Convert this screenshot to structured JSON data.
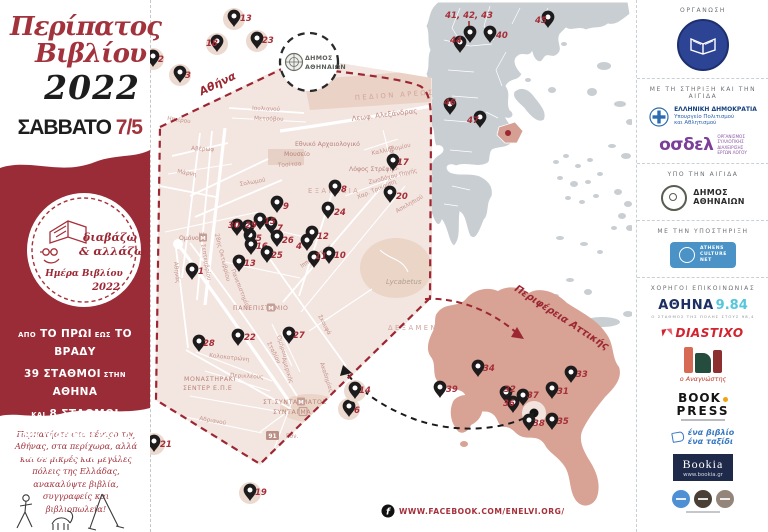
{
  "left": {
    "title1": "Περίπατος",
    "title2": "Βιβλίου",
    "year": "2022",
    "day": "ΣΑΒΒΑΤΟ",
    "date": "7/5",
    "badge": {
      "l1": "διαβάζω",
      "l2": "& αλλάζω",
      "l3": "Ημέρα Βιβλίου",
      "l4": "2022"
    },
    "promo": [
      [
        {
          "t": "ΑΠΟ",
          "s": "sm"
        },
        {
          "t": "ΤΟ ΠΡΩΙ",
          "s": "lg"
        },
        {
          "t": "ΕΩΣ",
          "s": "sm"
        },
        {
          "t": "ΤΟ ΒΡΑΔΥ",
          "s": "lg"
        }
      ],
      [
        {
          "t": "39 ΣΤΑΘΜΟΙ",
          "s": "lg"
        },
        {
          "t": "ΣΤΗΝ",
          "s": "sm"
        },
        {
          "t": "ΑΘΗΝΑ",
          "s": "lg"
        }
      ],
      [
        {
          "t": "ΚΑΙ",
          "s": "sm"
        },
        {
          "t": "8 ΣΤΑΘΜΟΙ",
          "s": "lg"
        }
      ],
      [
        {
          "t": "ΣΤΗΝ ΥΠΟΛΟΙΠΗ ΕΛΛΑΔΑ",
          "s": "md"
        }
      ],
      [
        {
          "t": "ΓΕΜΑΤΟΙ ΒΙΒΛΙΑ!",
          "s": "xl"
        }
      ]
    ],
    "description": "Περπατήστε στο κέντρο της Αθήνας, στα περίχωρα, αλλά και σε μικρές και μεγάλες πόλεις της Ελλάδας, ανακαλύψτε βιβλία, συγγραφείς και βιβλιοπωλεία!"
  },
  "map": {
    "athens_label": "Αθήνα",
    "attica_label": "Περιφέρεια Αττικής",
    "cluster_annotation": "41, 42, 43",
    "municipality_circle": {
      "line1": "ΔΗΜΟΣ",
      "line2": "ΑΘΗΝΑΙΩΝ"
    },
    "metro_letter": "Μ",
    "street_labels": [
      {
        "t": "ΠΕΔΙΟΝ ΑΡΕΩΣ",
        "x": 355,
        "y": 100,
        "r": -4,
        "c": "area"
      },
      {
        "t": "Λεωφ. Αλεξάνδρας",
        "x": 352,
        "y": 121,
        "r": -7,
        "c": "street-lg"
      },
      {
        "t": "Εθνικό Αρχαιολογικό",
        "x": 295,
        "y": 146,
        "r": 0,
        "c": "poi"
      },
      {
        "t": "Μουσείο",
        "x": 284,
        "y": 156,
        "r": 0,
        "c": "poi"
      },
      {
        "t": "Τοσίτσα",
        "x": 278,
        "y": 167,
        "r": -4,
        "c": "street"
      },
      {
        "t": "Σολωμού",
        "x": 240,
        "y": 186,
        "r": -10,
        "c": "street"
      },
      {
        "t": "ΕΞΑΡΧΕΙΑ",
        "x": 308,
        "y": 193,
        "r": 0,
        "c": "area"
      },
      {
        "t": "Λόφος Στρέφη",
        "x": 349,
        "y": 171,
        "r": 0,
        "c": "poi"
      },
      {
        "t": "Ζωοδόχου Πηγής",
        "x": 369,
        "y": 184,
        "r": -14,
        "c": "street"
      },
      {
        "t": "Χαρ. Τρικούπη",
        "x": 358,
        "y": 199,
        "r": -23,
        "c": "street"
      },
      {
        "t": "Ιπποκράτους",
        "x": 302,
        "y": 268,
        "r": -35,
        "c": "street"
      },
      {
        "t": "Ασκληπιού",
        "x": 397,
        "y": 213,
        "r": -30,
        "c": "street"
      },
      {
        "t": "Μάρνη",
        "x": 177,
        "y": 173,
        "r": 10,
        "c": "street"
      },
      {
        "t": "Αβέρωφ",
        "x": 191,
        "y": 150,
        "r": 3,
        "c": "street"
      },
      {
        "t": "3ης Σεπτεμβρίου",
        "x": 199,
        "y": 232,
        "r": 80,
        "c": "street"
      },
      {
        "t": "28ης Οκτωβρίου",
        "x": 215,
        "y": 234,
        "r": 76,
        "c": "street"
      },
      {
        "t": "Ηπείρου",
        "x": 167,
        "y": 120,
        "r": 8,
        "c": "street"
      },
      {
        "t": "Ιουλιανού",
        "x": 252,
        "y": 110,
        "r": 2,
        "c": "street"
      },
      {
        "t": "Μετσόβου",
        "x": 254,
        "y": 120,
        "r": 2,
        "c": "street"
      },
      {
        "t": "Ομόνοια",
        "x": 179,
        "y": 240,
        "r": 0,
        "c": "poi",
        "b": "M",
        "bx": 199
      },
      {
        "t": "Αθηνάς",
        "x": 174,
        "y": 262,
        "r": 84,
        "c": "street"
      },
      {
        "t": "Πανεπιστημίου",
        "x": 231,
        "y": 270,
        "r": 68,
        "c": "street"
      },
      {
        "t": "Σταδίου",
        "x": 267,
        "y": 343,
        "r": 63,
        "c": "street"
      },
      {
        "t": "Ομήρου",
        "x": 277,
        "y": 336,
        "r": 73,
        "c": "street"
      },
      {
        "t": "Αμερικής",
        "x": 282,
        "y": 358,
        "r": 73,
        "c": "street"
      },
      {
        "t": "Ακαδημίας",
        "x": 320,
        "y": 363,
        "r": 72,
        "c": "street"
      },
      {
        "t": "Σκουφά",
        "x": 318,
        "y": 316,
        "r": 62,
        "c": "street"
      },
      {
        "t": "ΔΕΞΑΜΕΝΗ",
        "x": 388,
        "y": 330,
        "r": 0,
        "c": "area"
      },
      {
        "t": "Lycabetus",
        "x": 386,
        "y": 284,
        "r": 0,
        "c": "hill"
      },
      {
        "t": "ΠΑΝΕΠΙΣΤΗΜΙΟ",
        "x": 233,
        "y": 310,
        "r": 0,
        "c": "station",
        "b": "M",
        "bx": 267
      },
      {
        "t": "ΜΟΝΑΣΤΗΡΑΚΙ",
        "x": 184,
        "y": 381,
        "r": 0,
        "c": "station"
      },
      {
        "t": "ΣΕΝΤΕΡ Ε.Π.Ε",
        "x": 183,
        "y": 390,
        "r": 0,
        "c": "station"
      },
      {
        "t": "Κολοκοτρώνη",
        "x": 209,
        "y": 357,
        "r": 6,
        "c": "street"
      },
      {
        "t": "Περικλέους",
        "x": 230,
        "y": 377,
        "r": 3,
        "c": "street"
      },
      {
        "t": "ΣΤ.ΣΥΝΤΑΓΜΑΤΟΣ",
        "x": 263,
        "y": 404,
        "r": 0,
        "c": "station",
        "b": "M",
        "bx": 297
      },
      {
        "t": "ΣΥΝΤΑΓΜΑ",
        "x": 273,
        "y": 414,
        "r": 0,
        "c": "station",
        "b": "sq",
        "bx": 299
      },
      {
        "t": "Αδριανού",
        "x": 199,
        "y": 420,
        "r": 10,
        "c": "street"
      },
      {
        "t": "Βατατζή",
        "x": 389,
        "y": 146,
        "r": 78,
        "c": "street"
      },
      {
        "t": "Καλλιδρομίου",
        "x": 372,
        "y": 155,
        "r": -12,
        "c": "street"
      },
      {
        "t": "Εθν.",
        "x": 286,
        "y": 438,
        "r": 0,
        "c": "street",
        "b": "91",
        "bx": 266
      }
    ],
    "athens_markers": [
      {
        "n": "1",
        "x": 192,
        "y": 280,
        "lx": 198,
        "ly": 274
      },
      {
        "n": "4",
        "x": 307,
        "y": 251,
        "lx": 296,
        "ly": 249
      },
      {
        "n": "5",
        "x": 250,
        "y": 246,
        "lx": 256,
        "ly": 241
      },
      {
        "n": "7",
        "x": 271,
        "y": 234,
        "lx": 277,
        "ly": 231
      },
      {
        "n": "8",
        "x": 335,
        "y": 197,
        "lx": 341,
        "ly": 192
      },
      {
        "n": "9",
        "x": 277,
        "y": 213,
        "lx": 283,
        "ly": 209
      },
      {
        "n": "10",
        "x": 329,
        "y": 264,
        "lx": 334,
        "ly": 258
      },
      {
        "n": "11",
        "x": 314,
        "y": 268,
        "lx": 315,
        "ly": 259
      },
      {
        "n": "12",
        "x": 312,
        "y": 243,
        "lx": 317,
        "ly": 239
      },
      {
        "n": "13",
        "x": 239,
        "y": 272,
        "lx": 244,
        "ly": 266
      },
      {
        "n": "15",
        "x": 260,
        "y": 230,
        "lx": 264,
        "ly": 224
      },
      {
        "n": "16",
        "x": 251,
        "y": 255,
        "lx": 256,
        "ly": 249
      },
      {
        "n": "17",
        "x": 393,
        "y": 171,
        "lx": 397,
        "ly": 165
      },
      {
        "n": "20",
        "x": 390,
        "y": 203,
        "lx": 396,
        "ly": 199
      },
      {
        "n": "22",
        "x": 238,
        "y": 346,
        "lx": 244,
        "ly": 340
      },
      {
        "n": "24",
        "x": 328,
        "y": 219,
        "lx": 334,
        "ly": 215
      },
      {
        "n": "25",
        "x": 267,
        "y": 263,
        "lx": 271,
        "ly": 258
      },
      {
        "n": "26",
        "x": 277,
        "y": 247,
        "lx": 282,
        "ly": 243
      },
      {
        "n": "27",
        "x": 289,
        "y": 344,
        "lx": 293,
        "ly": 338
      },
      {
        "n": "28",
        "x": 199,
        "y": 352,
        "lx": 203,
        "ly": 346
      },
      {
        "n": "29",
        "x": 248,
        "y": 237,
        "lx": 245,
        "ly": 228
      },
      {
        "n": "30",
        "x": 237,
        "y": 236,
        "lx": 228,
        "ly": 228
      }
    ],
    "circled_markers": [
      {
        "n": "2",
        "x": 153,
        "y": 67,
        "lx": 158,
        "ly": 62
      },
      {
        "n": "3",
        "x": 180,
        "y": 83,
        "lx": 185,
        "ly": 78
      },
      {
        "n": "13",
        "x": 234,
        "y": 27,
        "lx": 240,
        "ly": 21
      },
      {
        "n": "18",
        "x": 217,
        "y": 52,
        "lx": 206,
        "ly": 46
      },
      {
        "n": "23",
        "x": 257,
        "y": 49,
        "lx": 262,
        "ly": 43
      },
      {
        "n": "21",
        "x": 154,
        "y": 452,
        "lx": 160,
        "ly": 447
      },
      {
        "n": "19",
        "x": 250,
        "y": 501,
        "lx": 255,
        "ly": 495
      },
      {
        "n": "6",
        "x": 349,
        "y": 417,
        "lx": 354,
        "ly": 413
      },
      {
        "n": "14",
        "x": 355,
        "y": 399,
        "lx": 359,
        "ly": 393
      }
    ],
    "greece_markers": [
      {
        "n": "40",
        "x": 490,
        "y": 43,
        "lx": 496,
        "ly": 38
      },
      {
        "n": "",
        "x": 470,
        "y": 43,
        "lx": 0,
        "ly": 0
      },
      {
        "n": "44",
        "x": 460,
        "y": 53,
        "lx": 450,
        "ly": 43
      },
      {
        "n": "45",
        "x": 548,
        "y": 28,
        "lx": 535,
        "ly": 23
      },
      {
        "n": "46",
        "x": 450,
        "y": 115,
        "lx": 444,
        "ly": 105
      },
      {
        "n": "47",
        "x": 480,
        "y": 128,
        "lx": 467,
        "ly": 123
      }
    ],
    "attica_markers": [
      {
        "n": "31",
        "x": 552,
        "y": 399,
        "lx": 557,
        "ly": 394
      },
      {
        "n": "32",
        "x": 506,
        "y": 403,
        "lx": 504,
        "ly": 392
      },
      {
        "n": "33",
        "x": 571,
        "y": 383,
        "lx": 576,
        "ly": 377
      },
      {
        "n": "34",
        "x": 478,
        "y": 377,
        "lx": 483,
        "ly": 371
      },
      {
        "n": "35",
        "x": 552,
        "y": 430,
        "lx": 557,
        "ly": 424
      },
      {
        "n": "36",
        "x": 513,
        "y": 413,
        "lx": 503,
        "ly": 406
      },
      {
        "n": "37",
        "x": 523,
        "y": 406,
        "lx": 527,
        "ly": 398
      },
      {
        "n": "38",
        "x": 529,
        "y": 431,
        "lx": 533,
        "ly": 426
      },
      {
        "n": "39",
        "x": 440,
        "y": 398,
        "lx": 446,
        "ly": 392
      }
    ]
  },
  "footer": {
    "facebook_text": "WWW.FACEBOOK.COM/ENELVI.ORG/"
  },
  "sponsors": {
    "org_heading": "ΟΡΓΑΝΩΣΗ",
    "support_heading": "ΜΕ ΤΗ ΣΤΗΡΙΞΗ ΚΑΙ ΤΗΝ ΑΙΓΙΔΑ",
    "ministry": {
      "l1": "ΕΛΛΗΝΙΚΗ ΔΗΜΟΚΡΑΤΙΑ",
      "l2": "Υπουργείο Πολιτισμού",
      "l3": "και Αθλητισμού"
    },
    "osdel": {
      "name": "οσδελ",
      "l1": "ΟΡΓΑΝΙΣΜΟΣ",
      "l2": "ΣΥΛΛΟΓΙΚΗΣ",
      "l3": "ΔΙΑΧΕΙΡΙΣΗΣ",
      "l4": "ΕΡΓΩΝ ΛΟΓΟΥ"
    },
    "aegis_heading": "ΥΠΟ ΤΗΝ ΑΙΓΙΔΑ",
    "athens_city": {
      "l1": "ΔΗΜΟΣ",
      "l2": "ΑΘΗΝΑΙΩΝ"
    },
    "support2_heading": "ΜΕ ΤΗΝ ΥΠΟΣΤΗΡΙΞΗ",
    "acn": {
      "l1": "ATHENS",
      "l2": "CULTURE",
      "l3": "NET"
    },
    "media_heading": "ΧΟΡΗΓΟΙ ΕΠΙΚΟΙΝΩΝΙΑΣ",
    "athina984": {
      "name": "ΑΘΗΝΑ",
      "freq": "9.84",
      "tagline": "Ο ΣΤΑΘΜΟΣ ΤΗΣ ΠΟΛΗΣ ΣΤΟΥΣ 98,4"
    },
    "diastixo": "DIASTIXO",
    "anagnostis": "ο Αναγνώστης",
    "bookpress": {
      "l1": "BOOK",
      "l2": "PRESS"
    },
    "enavivlio": {
      "l1": "ένα βιβλίο",
      "l2": "ένα ταξίδι"
    },
    "bookia": {
      "name": "Bookia",
      "url": "www.bookia.gr"
    }
  }
}
